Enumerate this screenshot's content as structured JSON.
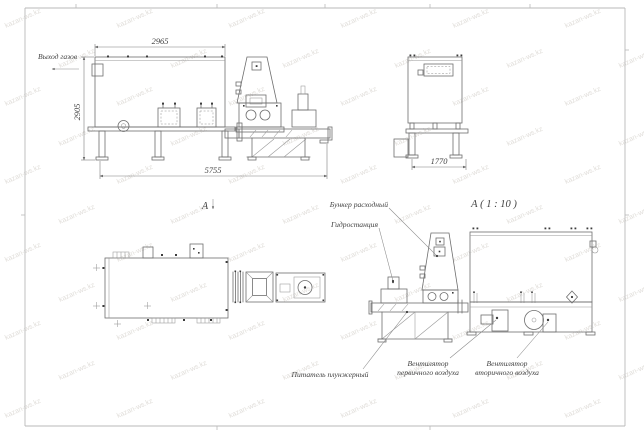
{
  "watermark": {
    "text": "kazan-ws.kz"
  },
  "front_view": {
    "gas_outlet_label": "Выход газов",
    "dim_top": "2965",
    "dim_left": "2905",
    "dim_bottom": "5755",
    "section_label": "А"
  },
  "side_view": {
    "dim_bottom": "1770"
  },
  "detail_view": {
    "title": "А ( 1 : 10 )",
    "callout_hopper": "Бункер расходный",
    "callout_hydraulic": "Гидростанция",
    "callout_feeder": "Питатель плунжерный",
    "callout_primary_fan": [
      "Вентилятор",
      "первичного воздуха"
    ],
    "callout_secondary_fan": [
      "Вентилятор",
      "вторичного воздуха"
    ]
  },
  "colors": {
    "background": "#ffffff",
    "line": "#6e6e6e",
    "thin_line": "#979797",
    "text": "#3f3f3f",
    "watermark": "#c6c1ba"
  }
}
